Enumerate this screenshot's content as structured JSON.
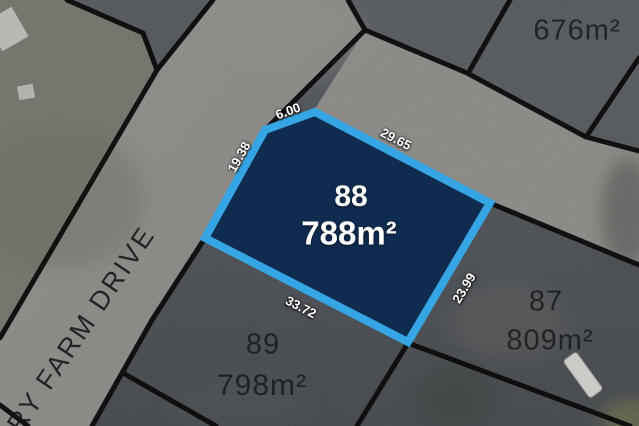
{
  "map": {
    "street_name": "RY FARM DRIVE",
    "highlight_lot": {
      "number": "88",
      "area": "788m²",
      "fill_color": "#0f2c50",
      "border_color": "#36a5e3",
      "dimensions": {
        "top": "6.00",
        "top_right": "29.65",
        "left": "19.38",
        "bottom": "33.72",
        "right": "23.99"
      }
    },
    "adjacent_lots": [
      {
        "number": "86",
        "area": "676m²"
      },
      {
        "number": "87",
        "area": "809m²"
      },
      {
        "number": "89",
        "area": "798m²"
      }
    ]
  }
}
